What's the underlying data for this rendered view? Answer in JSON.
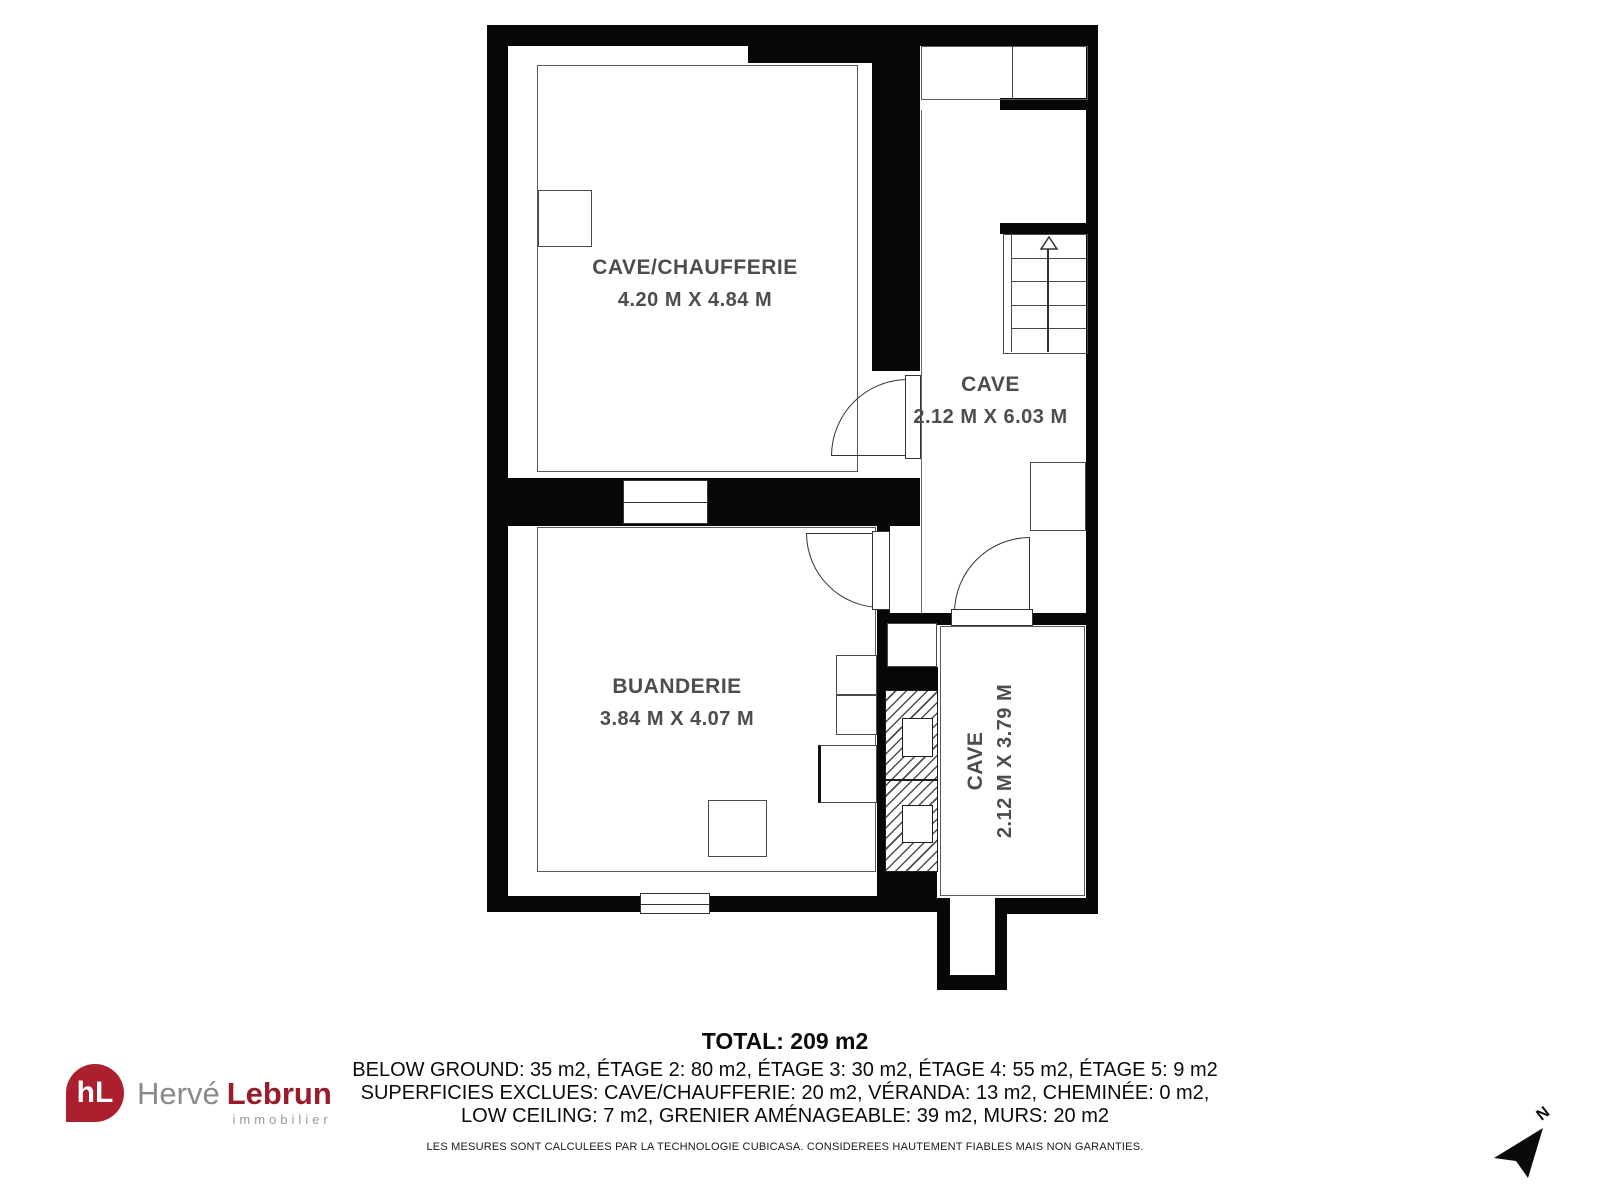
{
  "plan": {
    "rooms": [
      {
        "id": "cave-chaufferie",
        "name": "CAVE/CHAUFFERIE",
        "dims": "4.20 M X 4.84 M"
      },
      {
        "id": "cave-corridor",
        "name": "CAVE",
        "dims": "2.12 M X 6.03 M"
      },
      {
        "id": "buanderie",
        "name": "BUANDERIE",
        "dims": "3.84 M X 4.07 M"
      },
      {
        "id": "cave-bottom",
        "name": "CAVE",
        "dims": "2.12 M X 3.79 M"
      }
    ],
    "stair_arrow": "up"
  },
  "footer": {
    "total": "TOTAL: 209 m2",
    "line1": "BELOW GROUND: 35 m2, ÉTAGE 2: 80 m2, ÉTAGE 3: 30 m2, ÉTAGE 4: 55 m2, ÉTAGE 5: 9 m2",
    "line2": "SUPERFICIES EXCLUES: CAVE/CHAUFFERIE: 20 m2, VÉRANDA: 13 m2, CHEMINÉE: 0 m2,",
    "line3": "LOW CEILING: 7 m2, GRENIER AMÉNAGEABLE: 39 m2, MURS: 20 m2",
    "disclaimer": "LES MESURES SONT CALCULEES PAR LA TECHNOLOGIE CUBICASA. CONSIDEREES HAUTEMENT FIABLES MAIS NON GARANTIES."
  },
  "logo": {
    "monogram": "hL",
    "name_first": "Hervé",
    "name_last": "Lebrun",
    "tagline": "immobilier",
    "brand_red": "#ab1f2e",
    "brand_dark_red": "#9b1b2a",
    "gray": "#8a8a8a"
  },
  "compass": {
    "label": "N"
  }
}
